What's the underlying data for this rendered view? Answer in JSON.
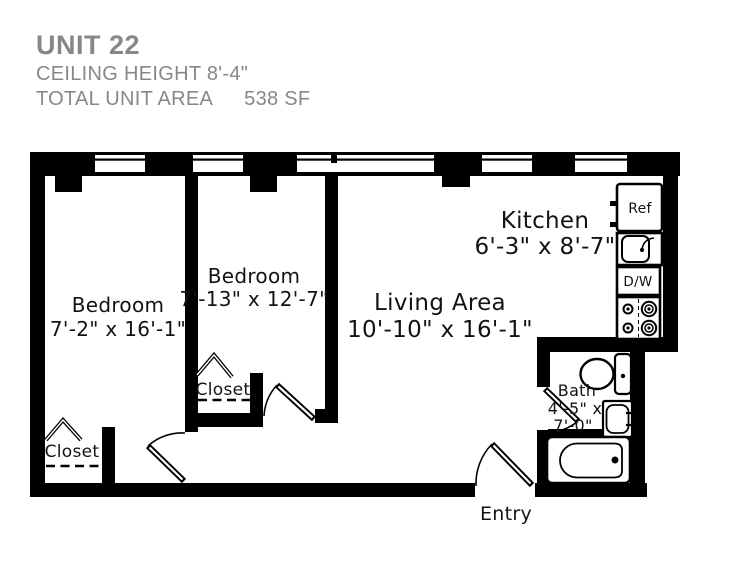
{
  "header": {
    "unit_title": "UNIT 22",
    "ceiling_height": "CEILING HEIGHT 8'-4\"",
    "total_area_label": "TOTAL UNIT AREA",
    "total_area_value": "538 SF"
  },
  "rooms": {
    "bedroom1": {
      "name": "Bedroom",
      "dims": "7'-2\" x 16'-1\""
    },
    "bedroom2": {
      "name": "Bedroom",
      "dims": "7'-13\" x 12'-7\""
    },
    "living": {
      "name": "Living Area",
      "dims": "10'-10\" x 16'-1\""
    },
    "kitchen": {
      "name": "Kitchen",
      "dims": "6'-3\" x 8'-7\""
    },
    "bath": {
      "name": "Bath",
      "dims_line1": "4'-5\" x",
      "dims_line2": "7'-0\""
    },
    "closet_bedroom1": {
      "name": "Closet"
    },
    "closet_bedroom2": {
      "name": "Closet"
    },
    "entry": {
      "name": "Entry"
    }
  },
  "appliances": {
    "refrigerator": "Ref",
    "dishwasher": "D/W"
  },
  "colors": {
    "wall": "#000000",
    "label_text": "#111417",
    "header_text": "#85878a"
  }
}
